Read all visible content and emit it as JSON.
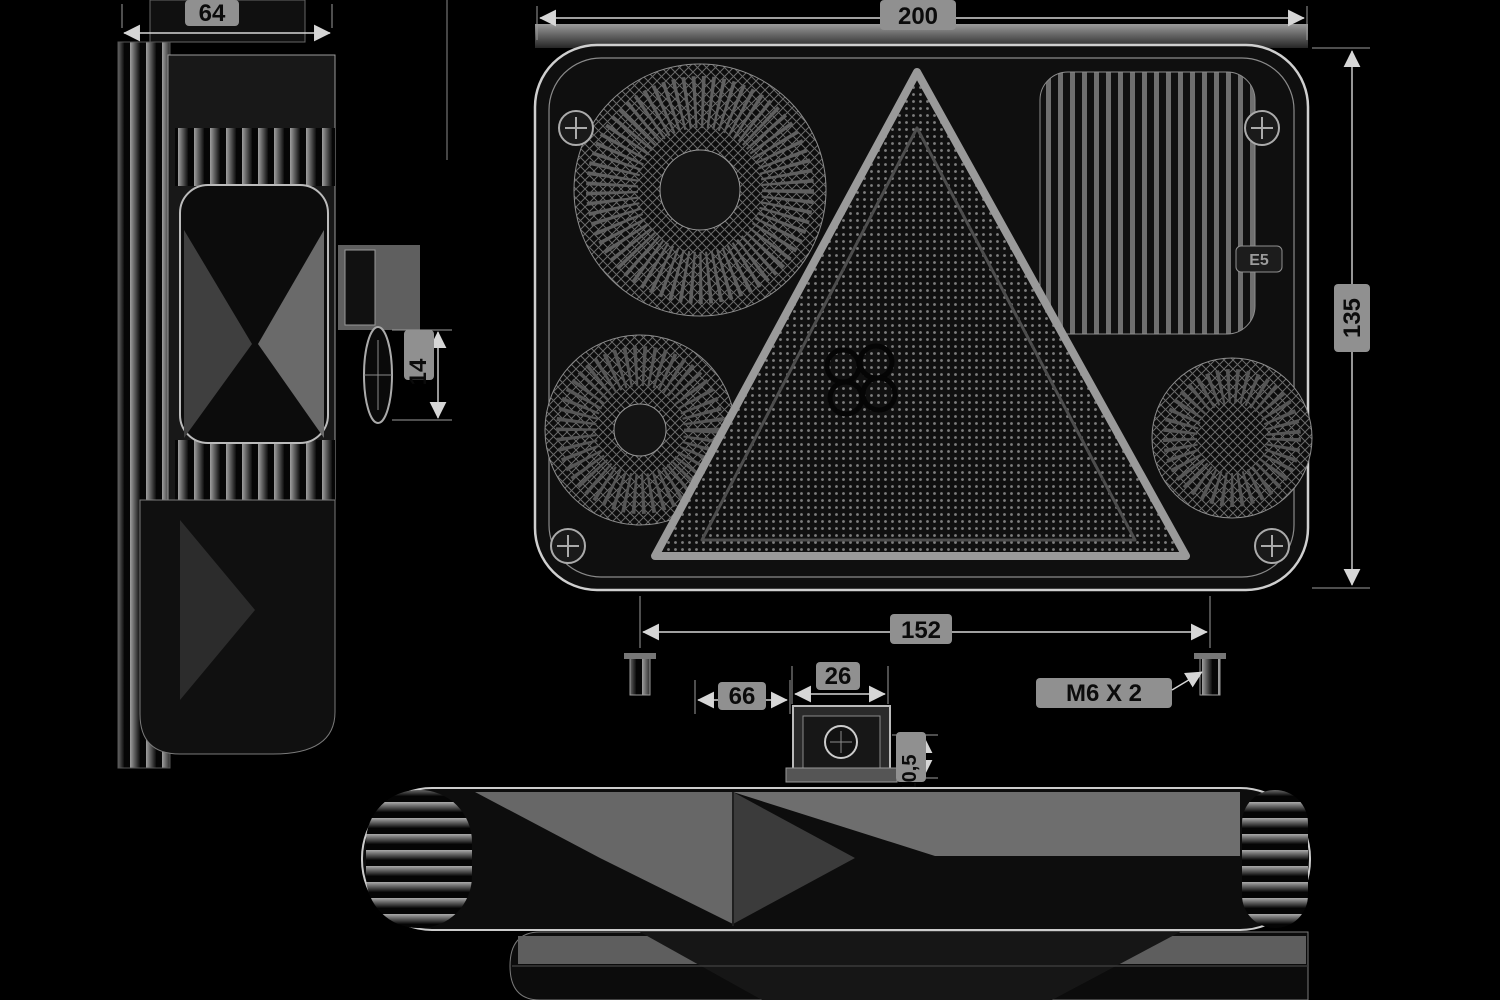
{
  "colors": {
    "bg": "#000000",
    "line": "#d6d6d6",
    "linesoft": "#8a8a8a",
    "filldark": "#0d0d0d",
    "fillmid": "#3f3f3f",
    "filllight": "#6e6e6e",
    "patch": "#909090",
    "dimtext": "#0b0b0b"
  },
  "views": {
    "front": {
      "width_dim": "200",
      "height_dim": "135",
      "approval_mark": "E5"
    },
    "side": {
      "depth_dim": "64",
      "stud_protrusion_dim": "14"
    },
    "mounting_detail": {
      "stud_spacing_dim": "152",
      "offset_dim": "66",
      "connector_width_dim": "26",
      "connector_height_dim": "10,5",
      "thread_spec": "M6 X 2"
    }
  }
}
